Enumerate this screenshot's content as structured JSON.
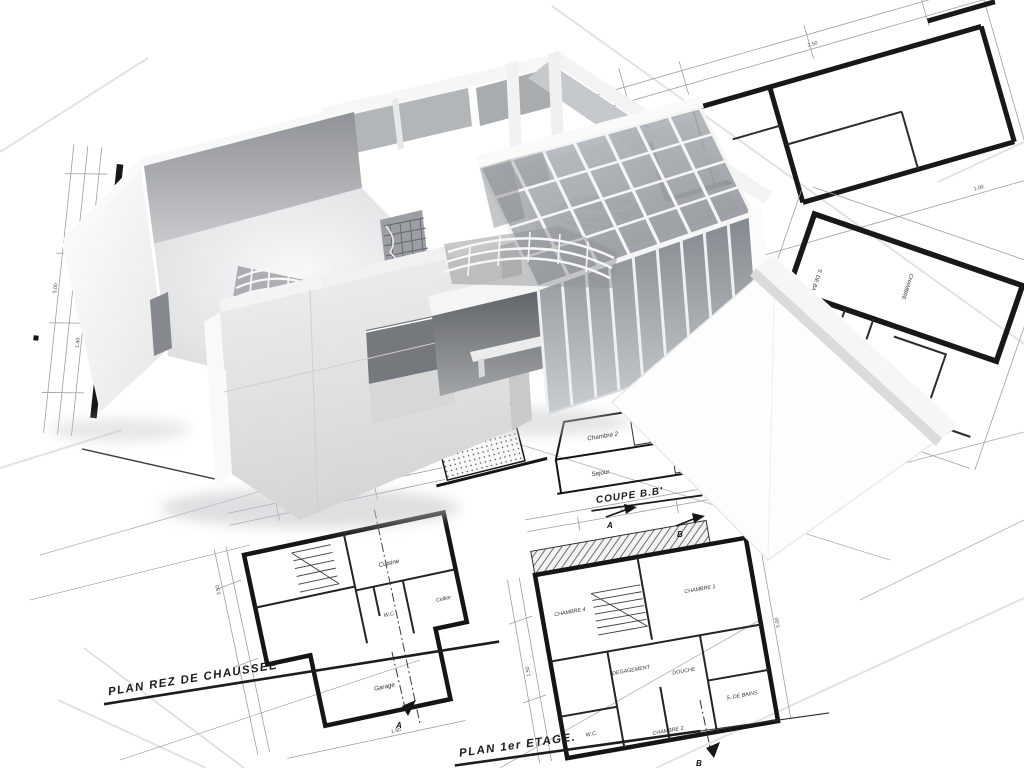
{
  "scene": {
    "type": "architectural-3d-render",
    "description": "White roofless 3D model of a modern house with a glazed atrium standing on scattered hand-drawn blueprint floor plans",
    "background": "#ffffff"
  },
  "palette": {
    "paper": "#fbfbfc",
    "ink_heavy": "#17181a",
    "ink_thin": "#8f959a",
    "model_white": "#f7f7f7",
    "model_light": "#e9eaeb",
    "model_mid": "#cfd1d3",
    "model_dark": "#aeb1b4",
    "interior_shadow": "#8f9296",
    "glass": "#b8bdc2",
    "shadow": "#c2c5c8"
  },
  "blueprints": {
    "ground_floor": {
      "label": "PLAN REZ DE CHAUSSEE",
      "rooms": [
        "Cuisine",
        "Cellier",
        "W.C.",
        "Garage"
      ]
    },
    "first_floor": {
      "label": "PLAN 1er ETAGE.",
      "rooms": [
        "CHAMBRE 1",
        "CHAMBRE 2",
        "CHAMBRE 4",
        "DEGAGEMENT",
        "DOUCHE",
        "S. DE BAINS",
        "W.C."
      ]
    },
    "section": {
      "label": "COUPE B.B'",
      "rooms": [
        "Chambre 2",
        "Sejour"
      ]
    },
    "right_sheet": {
      "rooms": [
        "CHAMBRE",
        "S. DE BAIN"
      ]
    },
    "axis_markers": [
      "A",
      "B"
    ],
    "dimensions": [
      "5.00",
      "3.50",
      "2.50",
      "1.80",
      "1.50",
      "1.00"
    ]
  }
}
